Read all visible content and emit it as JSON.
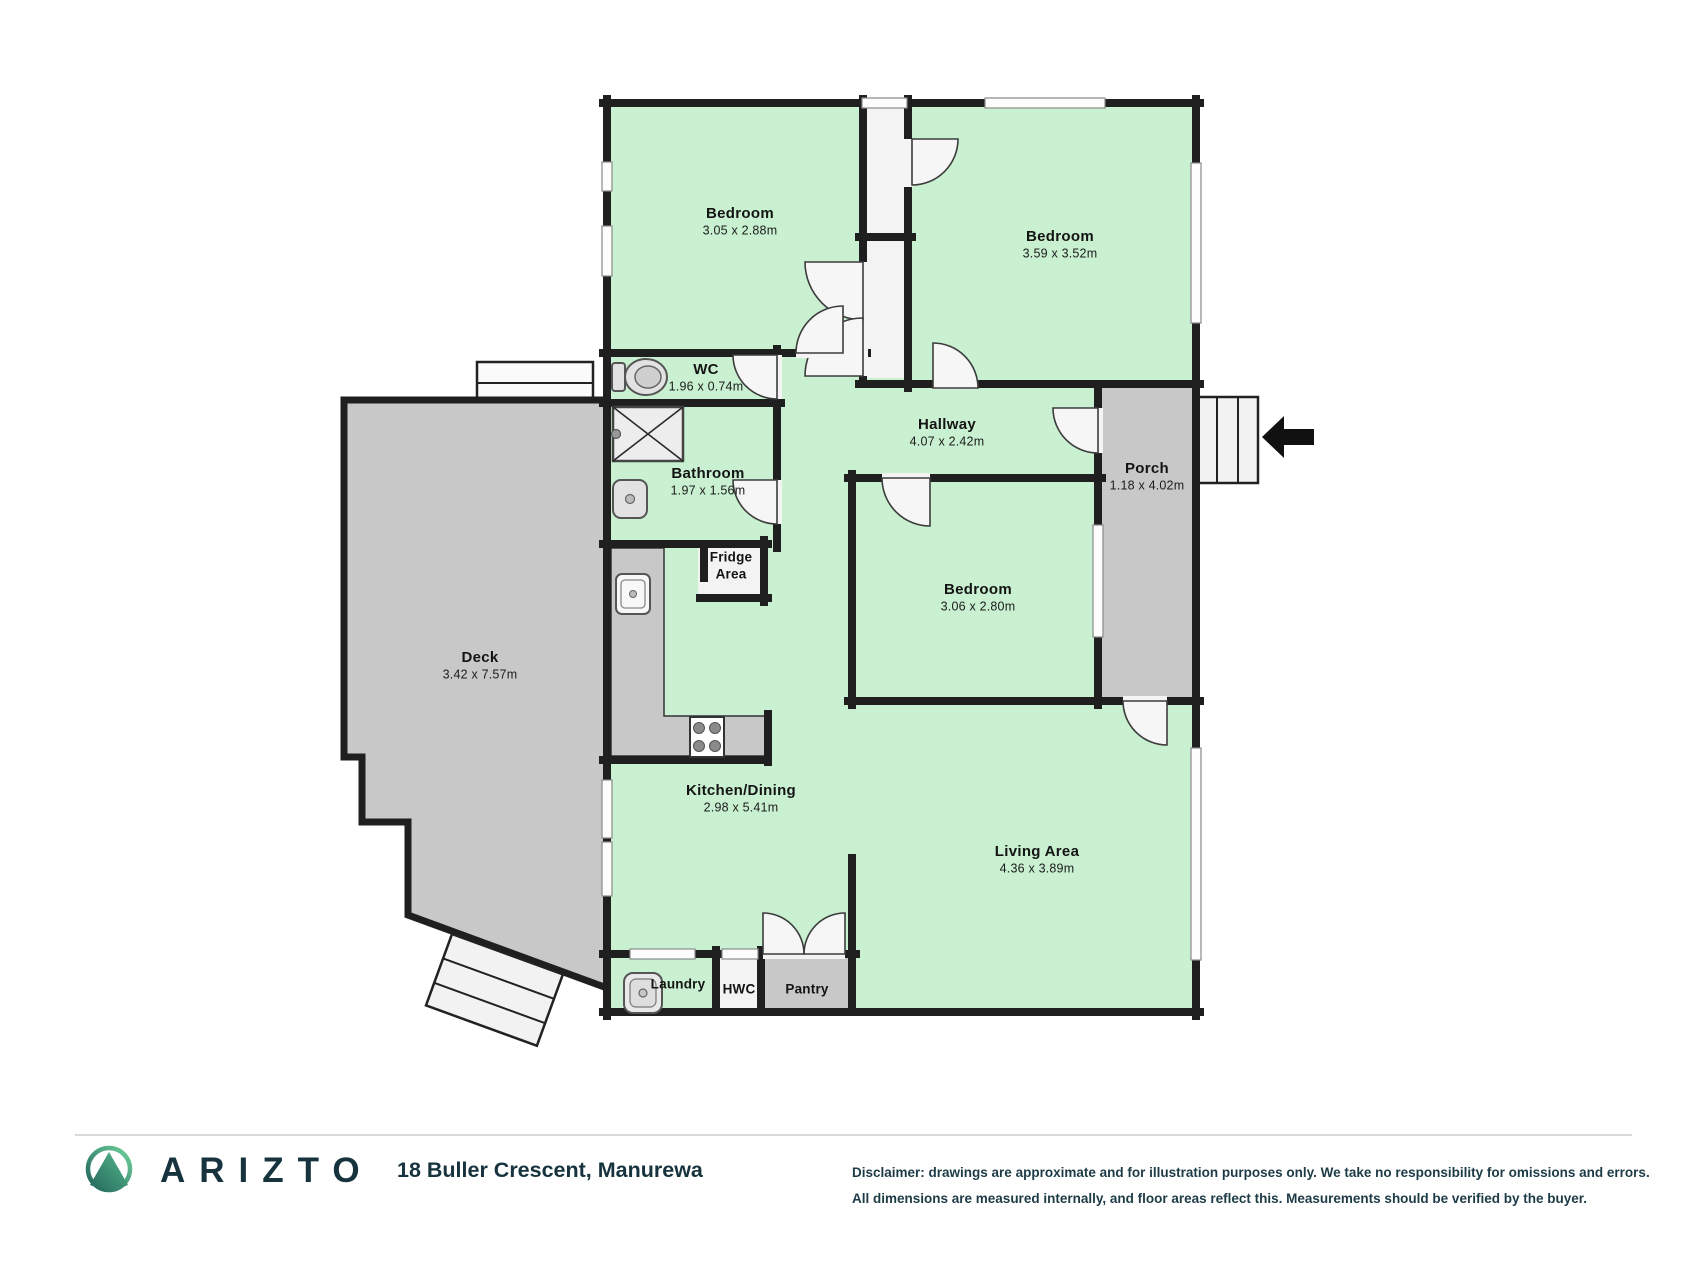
{
  "floor_plan": {
    "rooms": [
      {
        "name": "Bedroom",
        "dims": "3.05 x 2.88m"
      },
      {
        "name": "Bedroom",
        "dims": "3.59 x 3.52m"
      },
      {
        "name": "WC",
        "dims": "1.96 x 0.74m"
      },
      {
        "name": "Bathroom",
        "dims": "1.97 x 1.56m"
      },
      {
        "name": "Hallway",
        "dims": "4.07 x 2.42m"
      },
      {
        "name": "Porch",
        "dims": "1.18 x 4.02m"
      },
      {
        "name": "Fridge",
        "name2": "Area"
      },
      {
        "name": "Bedroom",
        "dims": "3.06 x 2.80m"
      },
      {
        "name": "Deck",
        "dims": "3.42 x 7.57m"
      },
      {
        "name": "Kitchen/Dining",
        "dims": "2.98 x 5.41m"
      },
      {
        "name": "Living Area",
        "dims": "4.36 x 3.89m"
      },
      {
        "name": "Laundry"
      },
      {
        "name": "HWC"
      },
      {
        "name": "Pantry"
      }
    ],
    "entry_arrow_direction": "left"
  },
  "footer": {
    "brand": "ARIZTO",
    "address": "18 Buller Crescent, Manurewa",
    "disclaimer_line1": "Disclaimer: drawings are approximate and for illustration purposes only. We take no responsibility for omissions and errors.",
    "disclaimer_line2": "All dimensions are measured internally, and floor areas reflect this. Measurements should be verified by the buyer."
  },
  "colors": {
    "room_fill": "#c9f0d0",
    "outdoor_fill": "#c8c8c8",
    "wall": "#1f1f1f",
    "brand_dark": "#16333e",
    "logo_teal": "#1d5f5a",
    "logo_green": "#6fd29a"
  }
}
